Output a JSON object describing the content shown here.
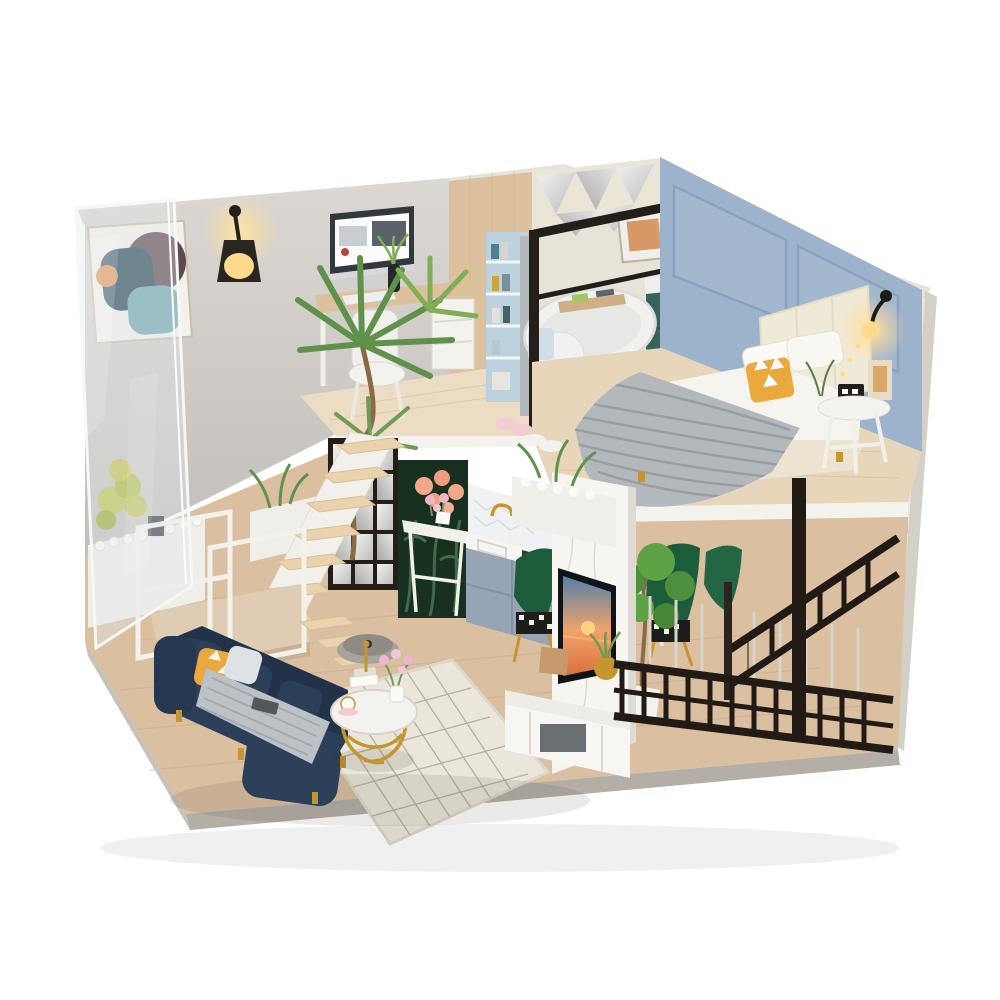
{
  "image": {
    "type": "product-photo",
    "subject": "DIY miniature dollhouse kit - two-story loft apartment diorama with lights",
    "background": "plain white seamless"
  },
  "palette": {
    "background": "#ffffff",
    "plywood_edge": "#dcd9d1",
    "plywood_edge_light": "#e6e3dc",
    "exterior_edge": "#d3d0c8",
    "concrete_wall": "#c8c4bf",
    "concrete_wall_light": "#dbd8d3",
    "wood_partition": "#ddc19e",
    "bookshelf_blue": "#bcd2df",
    "bathroom_wall": "#ebe5d8",
    "bedroom_wall_blue": "#9db3cb",
    "bedroom_panel_line": "#88a2bf",
    "upper_floor_wood": "#e8d6bb",
    "study_floor_wood": "#ecdcc4",
    "fascia_white": "#f4f2ec",
    "lower_floor_wood": "#dabfa1",
    "base_edge_gray": "#b3afa6",
    "base_side_gray": "#c6c2b9",
    "acrylic_tint": "rgba(226,231,236,0.38)",
    "sofa_navy": "#2c3f58",
    "sofa_navy_dark": "#223349",
    "throw_gray": "#bcc1c5",
    "pillow_yellow": "#e9a93d",
    "gold_metal": "#c5962f",
    "rug_cream": "#eae6da",
    "rug_line": "#b7b1a2",
    "stair_tread": "#ead2ad",
    "stair_white": "#f2f0ea",
    "railing_black": "#211a15",
    "kitchen_cabinet": "#97a4b6",
    "kitchen_tile": "#eff1f2",
    "vanity_teal": "#1e4f46",
    "plant_green": "#5f914c",
    "plant_green_dark": "#3c6b46",
    "plant_yellow_green": "#c2c44e",
    "botanical_panel_dark": "#17301f",
    "flower_peach": "#f2a88b",
    "flower_pink": "#efb6cb",
    "headboard_cream": "#efe9d8",
    "mattress_white": "#f6f4ef",
    "blanket_knit_gray": "#b3b8bc",
    "tv_black": "#101417",
    "marble_white": "#f6f5f2",
    "monitor_dark": "#33383d",
    "lamp_glow": "#ffd98c",
    "mirror_silver": "#d9dcde",
    "screen_facet_light": "#efefef",
    "screen_facet_dark": "#b9b9b9"
  },
  "objects": {
    "upper_floor": [
      "abstract-wall-art",
      "wall-lamp",
      "yucca-plant",
      "study-desk",
      "imac-monitor",
      "desk-chair",
      "drawer-unit",
      "bookshelf",
      "faceted-mirror-wall",
      "bathroom-glass-partition",
      "bathtub",
      "bath-caddy",
      "vanity-cabinet",
      "vanity-mirror",
      "bathroom-art",
      "monstera-plant",
      "bed",
      "headboard",
      "yellow-accent-pillow",
      "knit-throw-blanket",
      "wall-sconces",
      "bedside-table",
      "alarm-clock",
      "photo-frame",
      "slippers"
    ],
    "lower_floor": [
      "staircase",
      "landing-railing",
      "indoor-garden-planters",
      "white-pebbles",
      "mirror-facet-screen",
      "botanical-panel",
      "flower-console",
      "kitchen-backsplash",
      "gold-faucet",
      "kitchen-counter",
      "kitchen-cabinets",
      "green-velvet-chairs",
      "dining-table",
      "potted-tree",
      "tv-marble-panel",
      "television",
      "tv-cabinet",
      "gold-planter",
      "balcony-railing",
      "stair-railing",
      "navy-sofa",
      "gray-throw",
      "coffee-table",
      "area-rug",
      "robot-vacuum"
    ]
  }
}
